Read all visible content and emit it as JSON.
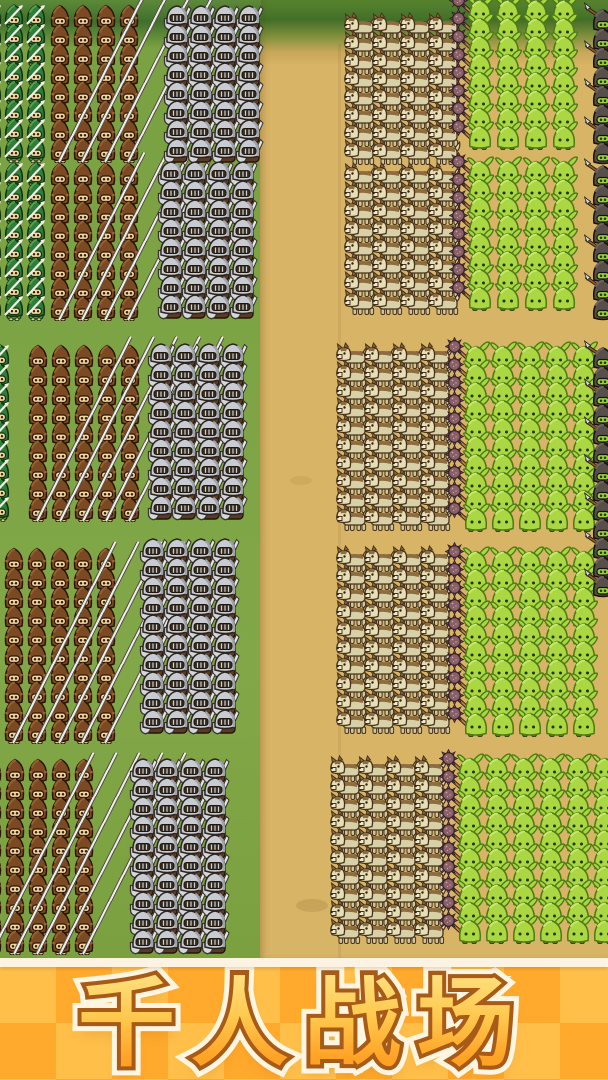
{
  "banner": {
    "title": "千人战场",
    "colors": {
      "checker_light": "#ffbf49",
      "checker_dark": "#ffa92d",
      "top_stripe": "#fcf3e2",
      "title_fill_top": "#ffdf7e",
      "title_fill_bottom": "#ffa124",
      "title_stroke_dark": "#a85a17",
      "title_stroke_light": "#fff5e0"
    }
  },
  "field": {
    "width": 608,
    "height": 958,
    "grass_color": "#7ca344",
    "forest_top_color": "#3f6f2c",
    "dirt_color": "#d8b466",
    "dirt_edge_color": "#b89a52"
  },
  "legend": {
    "archer": "green-hooded archer holding a silver arrow",
    "lancer": "brown-hooded lancer carrying a long silver pike",
    "knight": "silver-helmet knight with kite shield and sword",
    "wolf": "tan war wolf facing left",
    "goblin": "green goblin warrior",
    "mace": "spiked mace carried by front-rank goblins",
    "spearman": "dark-hooded goblin spearman at right edge"
  },
  "formations": {
    "unit_sizes": {
      "archer": [
        24,
        28
      ],
      "lancer": [
        24,
        28
      ],
      "knight": [
        30,
        30
      ],
      "wolf": [
        34,
        28
      ],
      "goblin": [
        28,
        30
      ],
      "spearman": [
        30,
        30
      ],
      "mace": [
        26,
        26
      ]
    },
    "blocks": [
      {
        "army": "left",
        "unit": "archer",
        "x": -20,
        "y": 2,
        "cols": 3,
        "rows": 8,
        "dx": 22,
        "dy": 19
      },
      {
        "army": "left",
        "unit": "archer",
        "x": -20,
        "y": 160,
        "cols": 3,
        "rows": 8,
        "dx": 22,
        "dy": 19
      },
      {
        "army": "left",
        "unit": "archer",
        "x": -12,
        "y": 342,
        "cols": 1,
        "rows": 9,
        "dx": 22,
        "dy": 19
      },
      {
        "army": "left",
        "unit": "lancer",
        "x": 48,
        "y": 2,
        "cols": 4,
        "rows": 8,
        "dx": 23,
        "dy": 19,
        "lances": true
      },
      {
        "army": "left",
        "unit": "lancer",
        "x": 48,
        "y": 160,
        "cols": 4,
        "rows": 8,
        "dx": 23,
        "dy": 19,
        "lances": true
      },
      {
        "army": "left",
        "unit": "lancer",
        "x": 26,
        "y": 342,
        "cols": 5,
        "rows": 9,
        "dx": 23,
        "dy": 19,
        "lances": true
      },
      {
        "army": "left",
        "unit": "lancer",
        "x": 2,
        "y": 545,
        "cols": 5,
        "rows": 10,
        "dx": 23,
        "dy": 19,
        "lances": true
      },
      {
        "army": "left",
        "unit": "lancer",
        "x": -20,
        "y": 756,
        "cols": 5,
        "rows": 10,
        "dx": 23,
        "dy": 19,
        "lances": true
      },
      {
        "army": "left",
        "unit": "knight",
        "x": 162,
        "y": 2,
        "cols": 4,
        "rows": 8,
        "dx": 24,
        "dy": 19
      },
      {
        "army": "left",
        "unit": "knight",
        "x": 156,
        "y": 158,
        "cols": 4,
        "rows": 8,
        "dx": 24,
        "dy": 19
      },
      {
        "army": "left",
        "unit": "knight",
        "x": 146,
        "y": 340,
        "cols": 4,
        "rows": 9,
        "dx": 24,
        "dy": 19
      },
      {
        "army": "left",
        "unit": "knight",
        "x": 138,
        "y": 535,
        "cols": 4,
        "rows": 10,
        "dx": 24,
        "dy": 19
      },
      {
        "army": "left",
        "unit": "knight",
        "x": 128,
        "y": 755,
        "cols": 4,
        "rows": 10,
        "dx": 24,
        "dy": 19
      },
      {
        "army": "right",
        "unit": "wolf",
        "x": 344,
        "y": 12,
        "cols": 4,
        "rows": 8,
        "dx": 28,
        "dy": 18
      },
      {
        "army": "right",
        "unit": "wolf",
        "x": 344,
        "y": 162,
        "cols": 4,
        "rows": 8,
        "dx": 28,
        "dy": 18
      },
      {
        "army": "right",
        "unit": "wolf",
        "x": 336,
        "y": 342,
        "cols": 4,
        "rows": 10,
        "dx": 28,
        "dy": 18
      },
      {
        "army": "right",
        "unit": "wolf",
        "x": 336,
        "y": 545,
        "cols": 4,
        "rows": 10,
        "dx": 28,
        "dy": 18
      },
      {
        "army": "right",
        "unit": "wolf",
        "x": 330,
        "y": 755,
        "cols": 4,
        "rows": 10,
        "dx": 28,
        "dy": 18
      },
      {
        "army": "right",
        "unit": "goblin",
        "x": 466,
        "y": -6,
        "cols": 4,
        "rows": 8,
        "dx": 28,
        "dy": 18,
        "mace": true
      },
      {
        "army": "right",
        "unit": "goblin",
        "x": 466,
        "y": 155,
        "cols": 4,
        "rows": 8,
        "dx": 28,
        "dy": 18,
        "mace": true
      },
      {
        "army": "right",
        "unit": "goblin",
        "x": 462,
        "y": 340,
        "cols": 5,
        "rows": 10,
        "dx": 27,
        "dy": 18,
        "mace": true
      },
      {
        "army": "right",
        "unit": "goblin",
        "x": 462,
        "y": 545,
        "cols": 5,
        "rows": 10,
        "dx": 27,
        "dy": 18,
        "mace": true
      },
      {
        "army": "right",
        "unit": "goblin",
        "x": 456,
        "y": 752,
        "cols": 6,
        "rows": 10,
        "dx": 27,
        "dy": 18,
        "mace": true
      },
      {
        "army": "right",
        "unit": "spearman",
        "x": 584,
        "y": 2,
        "cols": 1,
        "rows": 8,
        "dx": 24,
        "dy": 19
      },
      {
        "army": "right",
        "unit": "spearman",
        "x": 584,
        "y": 158,
        "cols": 1,
        "rows": 8,
        "dx": 24,
        "dy": 19
      },
      {
        "army": "right",
        "unit": "spearman",
        "x": 584,
        "y": 340,
        "cols": 1,
        "rows": 13,
        "dx": 24,
        "dy": 19
      }
    ]
  }
}
